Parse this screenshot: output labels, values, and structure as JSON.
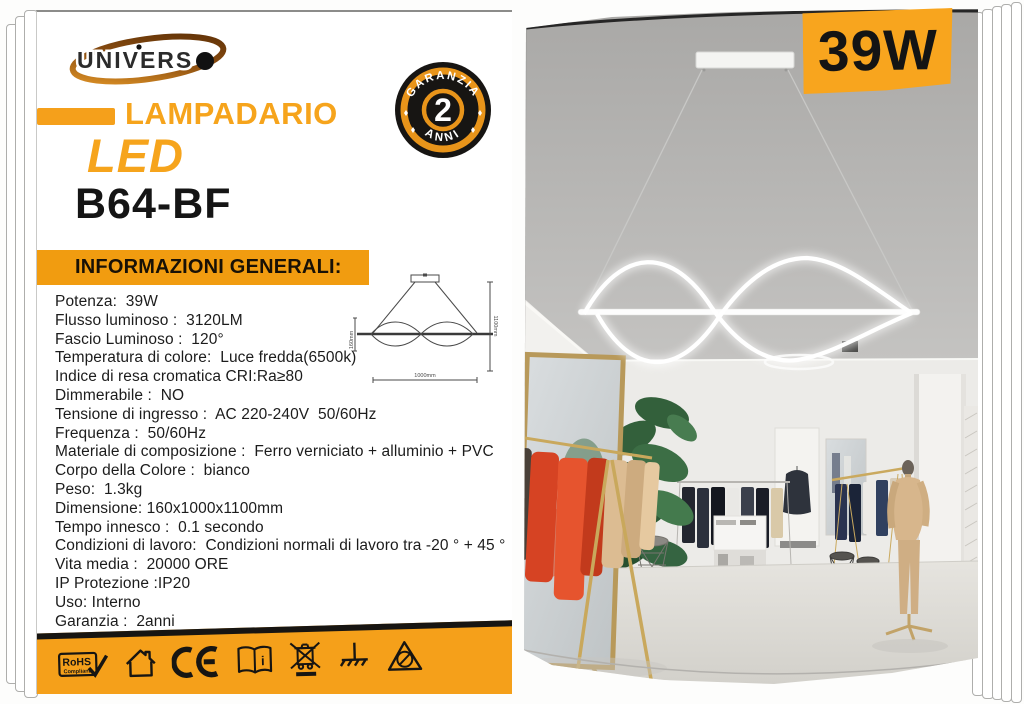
{
  "brand": {
    "logo_text": "UNIVERS",
    "logo_dot": "●"
  },
  "power_badge": "39W",
  "warranty_badge": {
    "top": "GARANZIA",
    "number": "2",
    "bottom": "ANNI"
  },
  "product": {
    "category": "LAMPADARIO",
    "tech": "LED",
    "model": "B64-BF"
  },
  "section": {
    "title": "INFORMAZIONI GENERALI:"
  },
  "specs": [
    "Potenza:  39W",
    "Flusso luminoso :  3120LM",
    "Fascio Luminoso :  120°",
    "Temperatura di colore:  Luce fredda(6500k)",
    "Indice di resa cromatica CRI:Ra≥80",
    "Dimmerabile :  NO",
    "Tensione di ingresso :  AC 220-240V  50/60Hz",
    "Frequenza :  50/60Hz",
    "Materiale di composizione :  Ferro verniciato + alluminio + PVC",
    "Corpo della Colore :  bianco",
    "Peso:  1.3kg",
    "Dimensione: 160x1000x1100mm",
    "Tempo innesco :  0.1 secondo",
    "Condizioni di lavoro:  Condizioni normali di lavoro tra -20 ° + 45 °",
    "Vita media :  20000 ORE",
    "IP Protezione :IP20",
    "Uso: Interno",
    "Garanzia :  2anni"
  ],
  "drawing": {
    "width_label": "1000mm",
    "height_label": "1100mm",
    "lamp_height_label": "160mm"
  },
  "footer": {
    "rohs_label": "RoHS",
    "rohs_sub": "Compliant",
    "ce_label": "CE",
    "manual_label": "i",
    "icons": [
      "rohs-compliant",
      "indoor-use-house",
      "ce-mark",
      "read-manual-book",
      "weee-crossed-bin",
      "earth-ground",
      "esd-warning-triangle"
    ]
  },
  "colors": {
    "accent_orange": "#F5A01B",
    "banner_orange": "#F19C10",
    "badge_orange": "#F8A51E",
    "text_dark": "#1c1c1c",
    "led_glow_white": "#FFFFFF"
  }
}
